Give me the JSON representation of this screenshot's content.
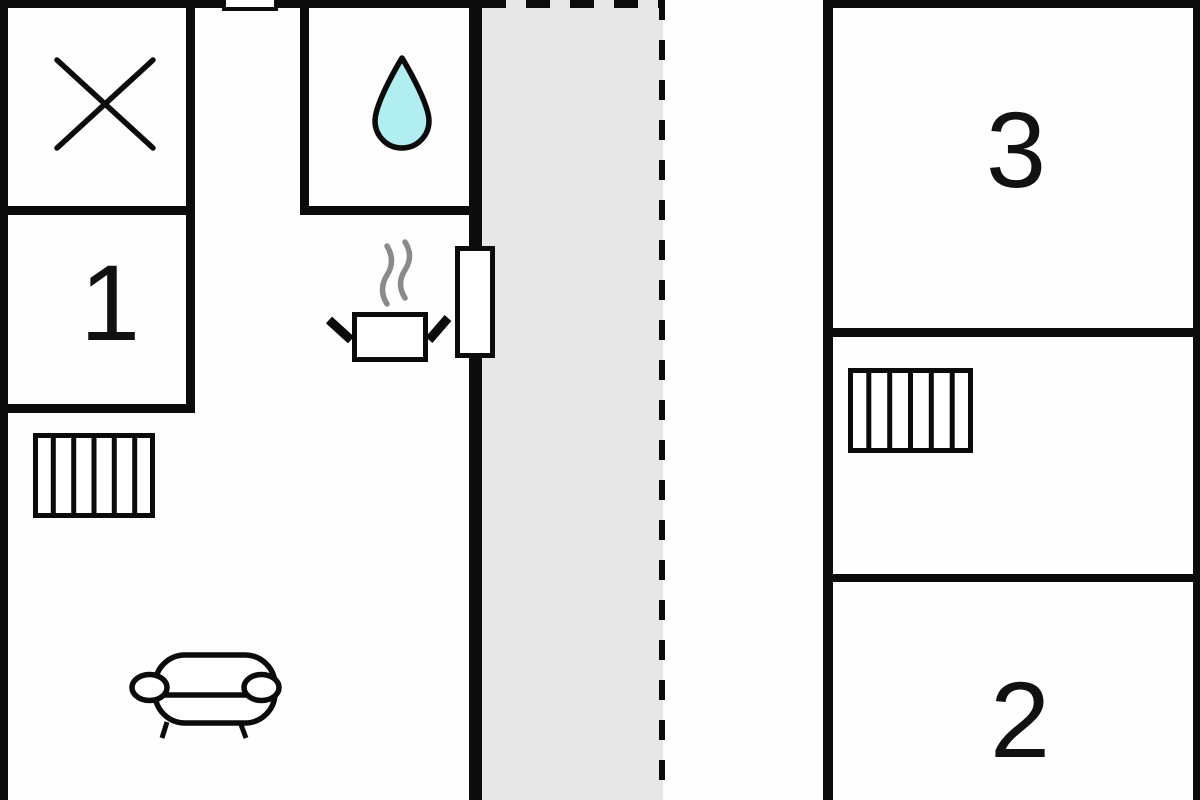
{
  "title": "floor-plan",
  "rooms": {
    "room1": {
      "label": "1"
    },
    "room2": {
      "label": "2"
    },
    "room3": {
      "label": "3"
    }
  },
  "areas": {
    "terrace": {
      "fill": "#e7e7e7",
      "border_style": "dashed"
    },
    "left_building": {
      "fill": "#ffffff"
    },
    "right_building": {
      "fill": "#ffffff"
    }
  },
  "icons": [
    {
      "name": "x-mark-icon",
      "meaning": "crossed diagonal lines marker"
    },
    {
      "name": "water-drop-icon",
      "meaning": "bathroom / water point"
    },
    {
      "name": "steam-icon",
      "meaning": "steam above pot"
    },
    {
      "name": "cooking-pot-icon",
      "meaning": "kitchen / stove"
    },
    {
      "name": "door-icon",
      "meaning": "door on wall to terrace"
    },
    {
      "name": "entrance-door-icon",
      "meaning": "door notch in top wall"
    },
    {
      "name": "stairs-icon-left",
      "meaning": "stairs / radiator hatching"
    },
    {
      "name": "stairs-icon-right",
      "meaning": "stairs / radiator hatching"
    },
    {
      "name": "sofa-icon",
      "meaning": "living room sofa"
    }
  ],
  "colors": {
    "wall": "#0b0b0b",
    "terrace_fill": "#e7e7e7",
    "water_drop_fill": "#b0eef2",
    "steam_gray": "#8a8a8a",
    "background": "#fefefe"
  }
}
